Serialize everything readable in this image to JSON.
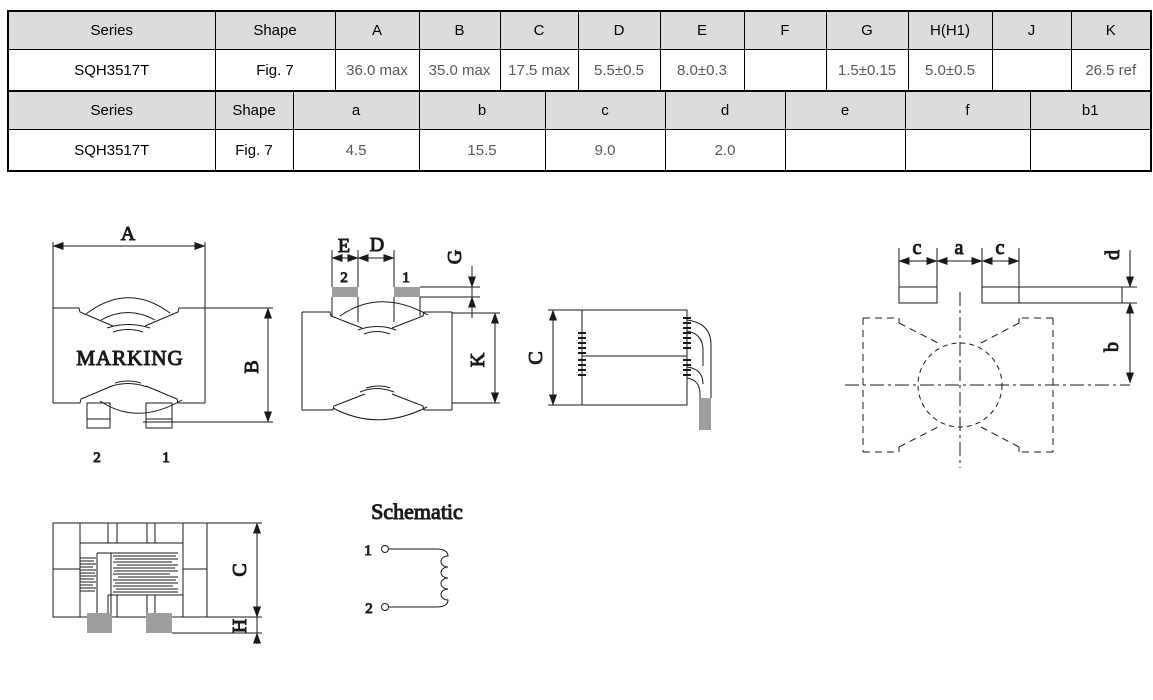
{
  "doc": {
    "type": "inductor-datasheet-dimensions"
  },
  "colors": {
    "table_header_bg": "#dcdcdc",
    "table_border": "#000000",
    "value_text": "#595959",
    "pad_gray": "#9e9e9e",
    "line": "#1a1a1a",
    "background": "#ffffff"
  },
  "table1": {
    "headers": [
      "Series",
      "Shape",
      "A",
      "B",
      "C",
      "D",
      "E",
      "F",
      "G",
      "H(H1)",
      "J",
      "K"
    ],
    "row": [
      "SQH3517T",
      "Fig. 7",
      "36.0 max",
      "35.0 max",
      "17.5 max",
      "5.5±0.5",
      "8.0±0.3",
      "",
      "1.5±0.15",
      "5.0±0.5",
      "",
      "26.5 ref"
    ]
  },
  "table2": {
    "headers": [
      "Series",
      "Shape",
      "a",
      "b",
      "c",
      "d",
      "e",
      "f",
      "b1"
    ],
    "row": [
      "SQH3517T",
      "Fig. 7",
      "4.5",
      "15.5",
      "9.0",
      "2.0",
      "",
      "",
      ""
    ]
  },
  "drawings": {
    "front_view": {
      "dim_width": "A",
      "dim_height": "B",
      "marking": "MARKING",
      "pin_left": "2",
      "pin_right": "1"
    },
    "bottom_view": {
      "dim_pad_width": "E",
      "dim_pad_gap": "D",
      "dim_pad_thickness": "G",
      "dim_body_height": "K",
      "pin_left": "2",
      "pin_right": "1"
    },
    "side_view": {
      "dim_height": "C"
    },
    "land_pattern": {
      "dim_pad_left": "c",
      "dim_center_gap": "a",
      "dim_pad_right": "c",
      "dim_pad_height": "d",
      "dim_offset": "b"
    },
    "section_view": {
      "dim_height": "C",
      "dim_terminal": "H"
    },
    "schematic": {
      "title": "Schematic",
      "pin_top": "1",
      "pin_bottom": "2"
    }
  }
}
